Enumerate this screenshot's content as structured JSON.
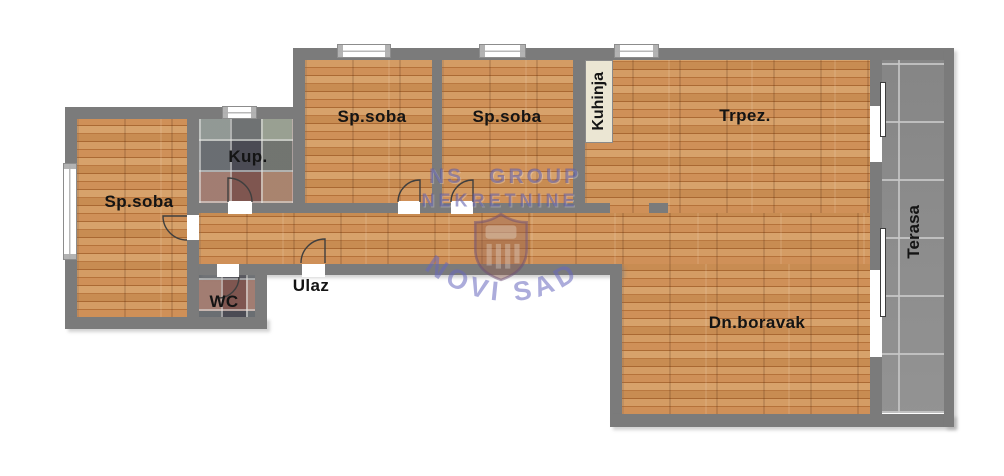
{
  "rooms": {
    "bedroom_left": "Sp.soba",
    "bathroom": "Kup.",
    "wc": "WC",
    "entry": "Ulaz",
    "bedroom_a": "Sp.soba",
    "bedroom_b": "Sp.soba",
    "kitchen": "Kuhinja",
    "dining": "Trpez.",
    "living": "Dn.boravak",
    "terrace": "Terasa"
  },
  "watermark": {
    "brand_line1": "NS GROUP",
    "brand_line2": "NEKRETNINE",
    "city": "NOVI SAD"
  },
  "colors": {
    "wall": "#7b7b7b",
    "wood_floor": "#c3824a",
    "terrace_tile": "#8d8d8d",
    "bath_tile_base": "#77777d",
    "kitchen_label_bg": "#ebe6d3",
    "watermark_blue": "#5656a8",
    "label_text": "#141414"
  }
}
